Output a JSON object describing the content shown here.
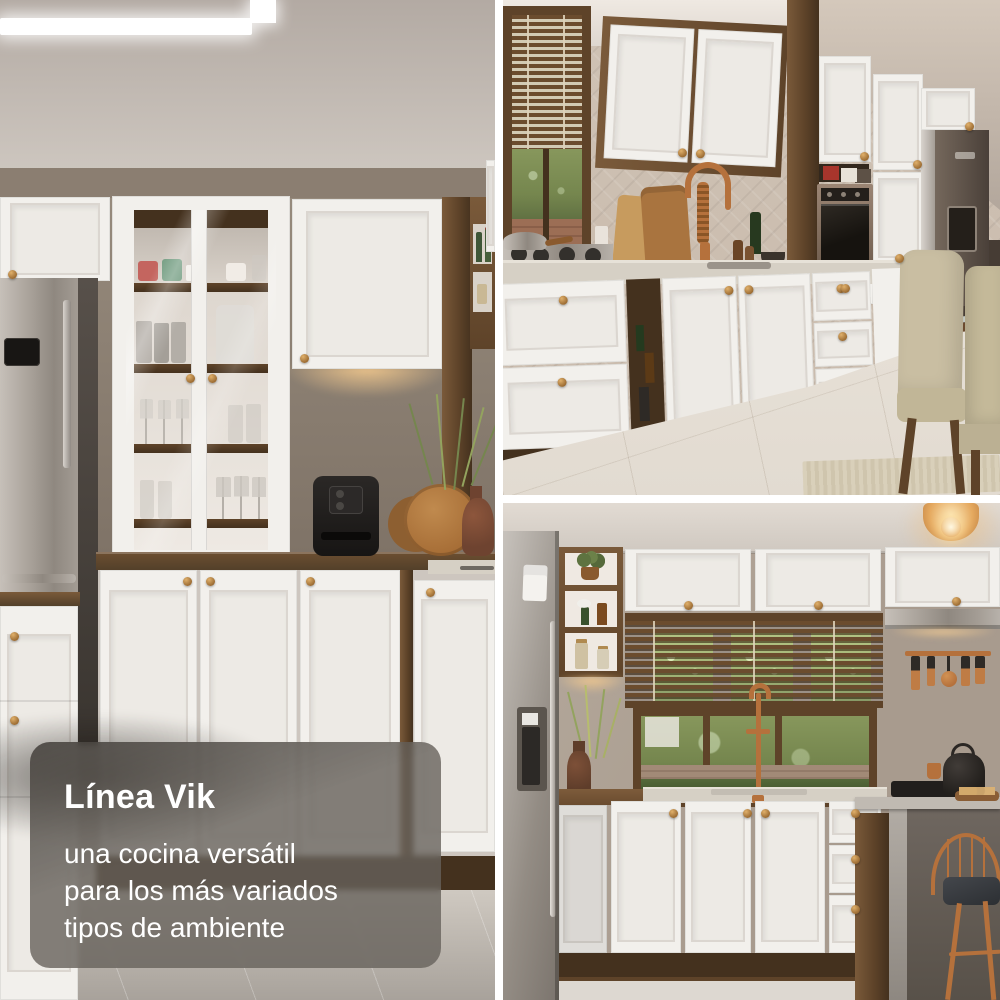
{
  "page": {
    "background": "#ffffff",
    "gutter_px": 8,
    "description": "Three-photo kitchen collage: full-height photo left, two stacked photos right, white gutters"
  },
  "caption": {
    "title": "Línea Vik",
    "lines": [
      "una cocina versátil",
      "para los más variados",
      "tipos de ambiente"
    ],
    "text_color": "#ffffff",
    "card_color": "rgba(103,97,91,0.8)"
  },
  "photos": {
    "left": {
      "alt": "Kitchen with stainless-steel fridge, white hutch with two glass doors displaying mugs and glassware on wood shelves, white shaker base cabinets with brass knobs, black air fryer, round wooden boards and a vase with greenery on a walnut countertop, white island drawers in front"
    },
    "top_right": {
      "alt": "Kitchen run with a window with wooden blinds, white upper cabinets on walnut carcass, herringbone backsplash, brass coil spring faucet over the sink, gas cooktop with pan, bronze built-in oven, dark steel fridge and two beige upholstered dining chairs by a glass table"
    },
    "bottom_right": {
      "alt": "Kitchen with amber pendant light, stainless fridge, walnut open shelves with plants and jars, white upper cabinets over a window with wooden blinds, range hood, copper utensil rail, white sink cabinets with brass faucet, concrete island with black kettle and cooktop, and a copper wire stool"
    }
  },
  "palette": {
    "cab": "#f2f0ec",
    "cab2": "#edeae5",
    "cabedge": "#dbd6d0",
    "wood": "#7a5a3a",
    "wood2": "#5e4329",
    "wood3": "#44311e",
    "steelA": "#c6c0b9",
    "steelB": "#8f8880",
    "brassA": "#e0b06b",
    "brassB": "#9c6c33",
    "copper": "#b5713c",
    "glow": "#f6cb8e",
    "wall": "#9b8d7f",
    "soffit": "#8b7e71",
    "ceilA": "#b3aaa3",
    "ceilB": "#cdc6bf",
    "herr": "#c8baac",
    "plaster": "#a89b8e",
    "floorA": "#eae4dc",
    "floorB": "#d9d2c8",
    "green1": "#75864e",
    "green2": "#93a35e",
    "black": "#211e1c",
    "chair": "#c9bea2",
    "concrete1": "#6f6760",
    "concrete2": "#b2aca5",
    "stone": "#d6d0c5",
    "overlay": "rgba(103,97,91,0.8)",
    "white": "#ffffff"
  }
}
